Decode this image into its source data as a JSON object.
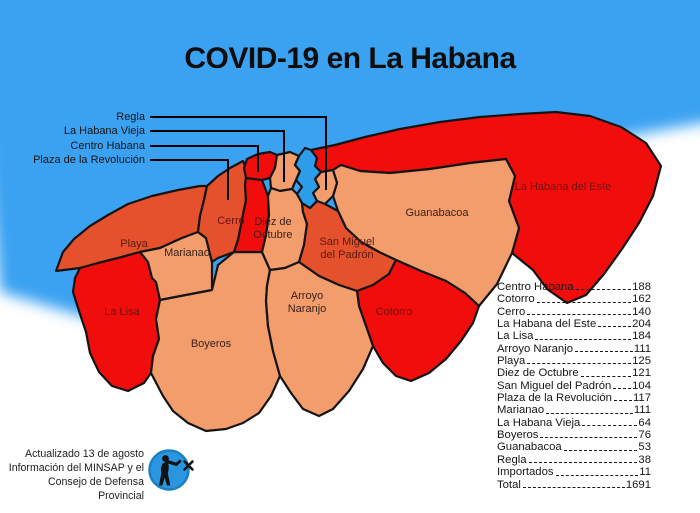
{
  "title": "COVID-19 en La Habana",
  "callouts": [
    {
      "label": "Regla"
    },
    {
      "label": "La Habana Vieja"
    },
    {
      "label": "Centro Habana"
    },
    {
      "label": "Plaza de la Revolución"
    }
  ],
  "map": {
    "labels": {
      "playa": "Playa",
      "marianao": "Marianao",
      "la_lisa": "La Lisa",
      "boyeros": "Boyeros",
      "cerro": "Cerro",
      "diez_1": "Diez de",
      "diez_2": "Octubre",
      "arroyo_1": "Arroyo",
      "arroyo_2": "Naranjo",
      "smp_1": "San Miguel",
      "smp_2": "del Padrón",
      "cotorro": "Cotorro",
      "guanabacoa": "Guanabacoa",
      "habana_del_este": "La Habana del Este"
    },
    "colors": {
      "red": "#f20d0d",
      "orange": "#e5512c",
      "salmon": "#f39d6d",
      "sea": "#3aa2f2",
      "bay": "#2d9ce9",
      "border": "#141414"
    }
  },
  "chart_data": {
    "type": "table",
    "title": "COVID-19 en La Habana",
    "categories": [
      "Centro Habana",
      "Cotorro",
      "Cerro",
      "La Habana del Este",
      "La Lisa",
      "Arroyo Naranjo",
      "Playa",
      "Diez de Octubre",
      "San Miguel del Padrón",
      "Plaza de la Revolución",
      "Marianao",
      "La Habana Vieja",
      "Boyeros",
      "Guanabacoa",
      "Regla",
      "Importados",
      "Total"
    ],
    "values": [
      188,
      162,
      140,
      204,
      184,
      111,
      125,
      121,
      104,
      117,
      111,
      64,
      76,
      53,
      38,
      11,
      1691
    ]
  },
  "stats": {
    "rows": [
      {
        "name": "Centro Habana",
        "value": "188"
      },
      {
        "name": "Cotorro",
        "value": "162"
      },
      {
        "name": "Cerro",
        "value": "140"
      },
      {
        "name": "La Habana del Este",
        "value": "204"
      },
      {
        "name": "La Lisa",
        "value": "184"
      },
      {
        "name": "Arroyo Naranjo",
        "value": "111"
      },
      {
        "name": "Playa",
        "value": "125"
      },
      {
        "name": "Diez de Octubre",
        "value": "121"
      },
      {
        "name": "San Miguel del Padrón",
        "value": "104"
      },
      {
        "name": "Plaza de la Revolución",
        "value": "117"
      },
      {
        "name": "Marianao",
        "value": "111"
      },
      {
        "name": "La Habana Vieja",
        "value": "64"
      },
      {
        "name": "Boyeros",
        "value": "76"
      },
      {
        "name": "Guanabacoa",
        "value": "53"
      },
      {
        "name": "Regla",
        "value": "38"
      },
      {
        "name": "Importados",
        "value": "11"
      },
      {
        "name": "Total",
        "value": "1691"
      }
    ]
  },
  "attribution": {
    "line1": "Actualizado 13 de agosto",
    "line2": "Información del MINSAP y el",
    "line3": "Consejo de Defensa Provincial"
  }
}
